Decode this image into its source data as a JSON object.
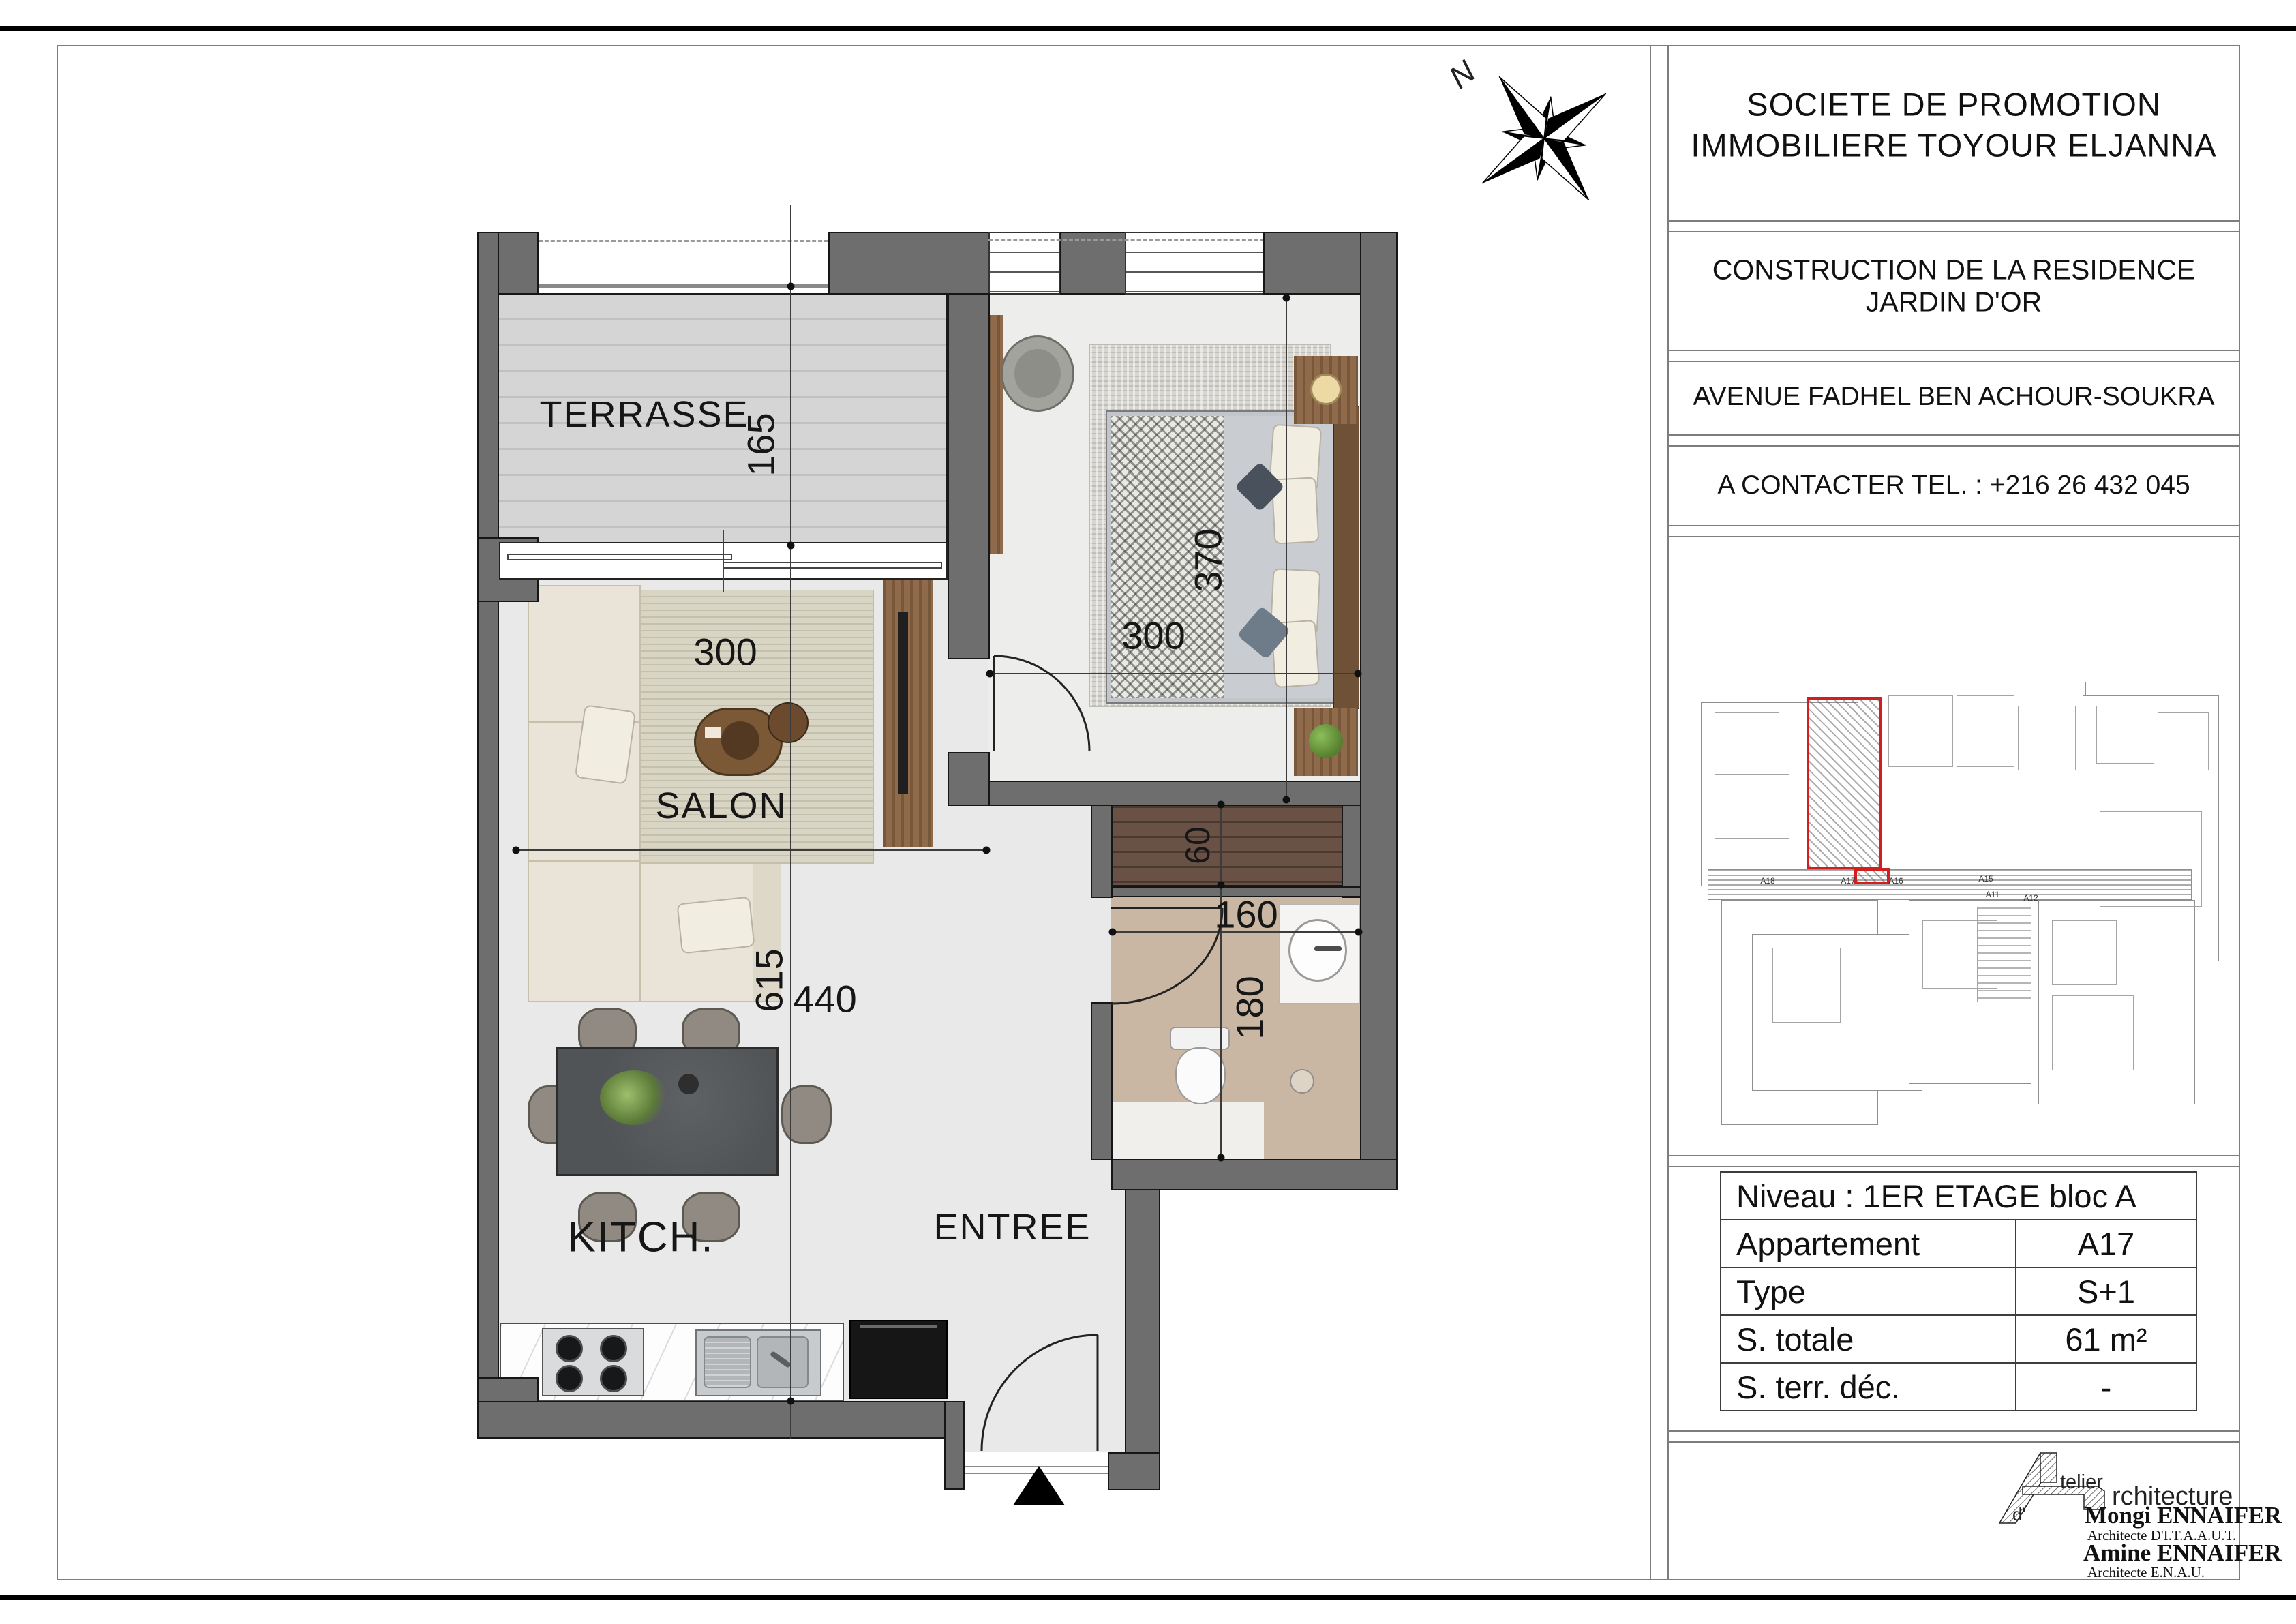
{
  "sheet": {
    "company": {
      "line1": "SOCIETE  DE  PROMOTION",
      "line2": "IMMOBILIERE  TOYOUR  ELJANNA"
    },
    "project": {
      "line1": "CONSTRUCTION  DE LA RESIDENCE",
      "line2": "JARDIN D'OR"
    },
    "address": "AVENUE FADHEL BEN ACHOUR-SOUKRA",
    "contact": "A  CONTACTER  TEL. :  +216 26 432 045"
  },
  "compass": {
    "north_label": "N"
  },
  "plan": {
    "rooms": {
      "terrasse": "TERRASSE",
      "salon": "SALON",
      "kitchen": "KITCH.",
      "entree": "ENTREE"
    },
    "dims": {
      "terrasse_depth": "165",
      "salon_width": "300",
      "salon_length": "440",
      "kitchen_length": "615",
      "bedroom_length": "370",
      "bedroom_width": "300",
      "wardrobe_depth": "60",
      "bath_width": "160",
      "bath_length": "180"
    }
  },
  "overview": {
    "unit_labels": [
      "A18",
      "A17",
      "A16",
      "A15",
      "A11",
      "A12"
    ]
  },
  "info_table": {
    "header": "Niveau : 1ER ETAGE bloc A",
    "rows": [
      {
        "label": "Appartement",
        "value": "A17"
      },
      {
        "label": "Type",
        "value": "S+1"
      },
      {
        "label": "S. totale",
        "value": "61 m²"
      },
      {
        "label": "S. terr. déc.",
        "value": "-"
      }
    ]
  },
  "logo": {
    "d": "d'",
    "atelier": "telier",
    "architecture": "rchitecture",
    "architect1": "Mongi ENNAIFER",
    "title1": "Architecte D'I.T.A.A.U.T.",
    "architect2": "Amine ENNAIFER",
    "title2": "Architecte  E.N.A.U."
  }
}
